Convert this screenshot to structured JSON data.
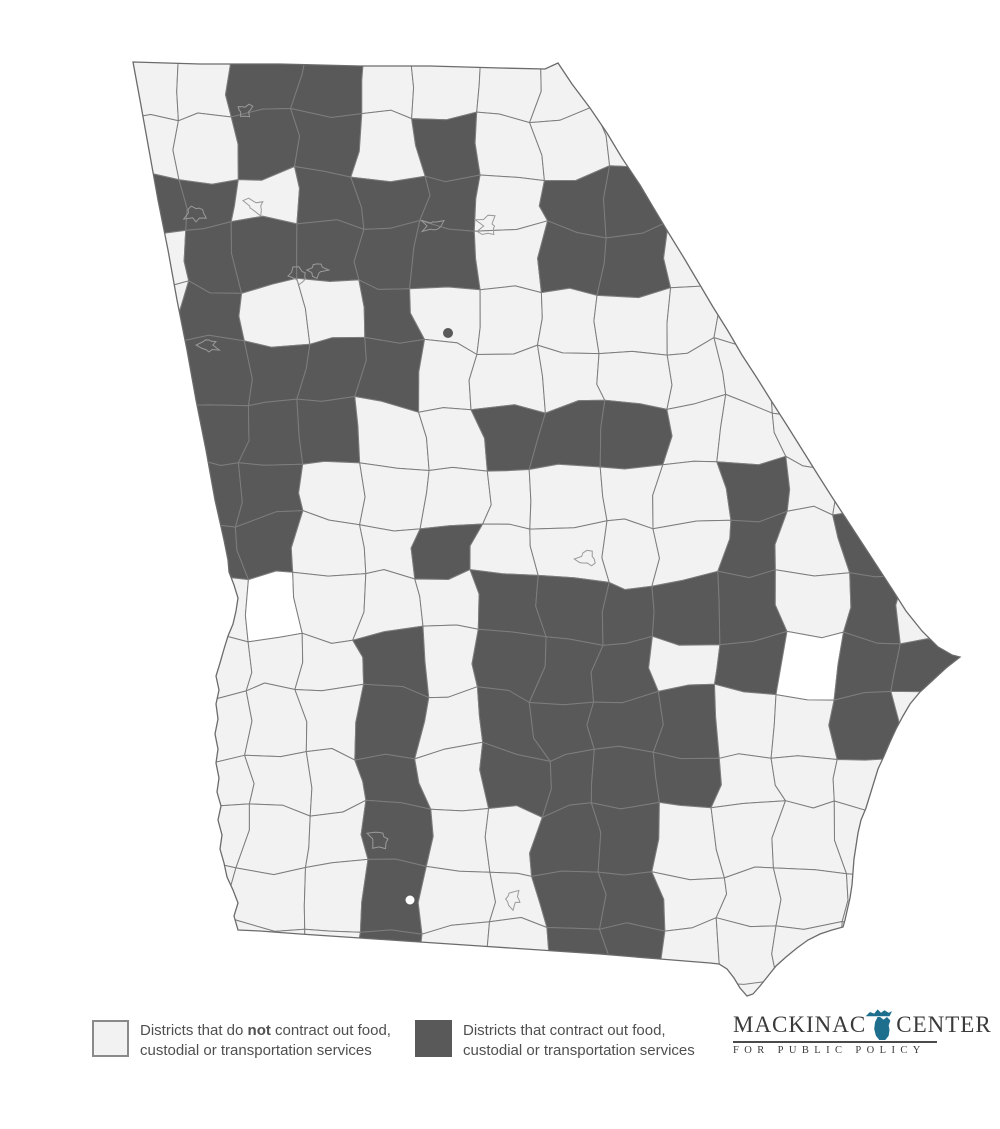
{
  "map": {
    "state": "Georgia",
    "description": "Georgia school districts (counties) shaded by whether they contract out food, custodial or transportation services",
    "colors": {
      "light_county": "#f2f2f2",
      "dark_county": "#595959",
      "white_county": "#ffffff",
      "county_border": "#7d7d7d",
      "state_outline": "#6b6b6b",
      "city_outline": "#9a9a9a"
    },
    "grid": {
      "cols": 14,
      "rows": 16,
      "x0": 120,
      "y0": 56,
      "cw": 60,
      "ch": 58
    },
    "dark_cells": [
      [
        2,
        0
      ],
      [
        3,
        0
      ],
      [
        2,
        1
      ],
      [
        3,
        1
      ],
      [
        5,
        1
      ],
      [
        0,
        2
      ],
      [
        1,
        2
      ],
      [
        3,
        2
      ],
      [
        4,
        2
      ],
      [
        5,
        2
      ],
      [
        7,
        2
      ],
      [
        8,
        2
      ],
      [
        1,
        3
      ],
      [
        2,
        3
      ],
      [
        3,
        3
      ],
      [
        4,
        3
      ],
      [
        5,
        3
      ],
      [
        7,
        3
      ],
      [
        8,
        3
      ],
      [
        1,
        4
      ],
      [
        4,
        4
      ],
      [
        1,
        5
      ],
      [
        2,
        5
      ],
      [
        3,
        5
      ],
      [
        4,
        5
      ],
      [
        1,
        6
      ],
      [
        2,
        6
      ],
      [
        3,
        6
      ],
      [
        6,
        6
      ],
      [
        7,
        6
      ],
      [
        8,
        6
      ],
      [
        1,
        7
      ],
      [
        2,
        7
      ],
      [
        10,
        7
      ],
      [
        1,
        8
      ],
      [
        2,
        8
      ],
      [
        5,
        8
      ],
      [
        10,
        8
      ],
      [
        12,
        8
      ],
      [
        6,
        9
      ],
      [
        7,
        9
      ],
      [
        8,
        9
      ],
      [
        9,
        9
      ],
      [
        10,
        9
      ],
      [
        12,
        9
      ],
      [
        4,
        10
      ],
      [
        6,
        10
      ],
      [
        7,
        10
      ],
      [
        8,
        10
      ],
      [
        10,
        10
      ],
      [
        12,
        10
      ],
      [
        13,
        10
      ],
      [
        4,
        11
      ],
      [
        6,
        11
      ],
      [
        7,
        11
      ],
      [
        8,
        11
      ],
      [
        9,
        11
      ],
      [
        12,
        11
      ],
      [
        4,
        12
      ],
      [
        6,
        12
      ],
      [
        7,
        12
      ],
      [
        8,
        12
      ],
      [
        9,
        12
      ],
      [
        4,
        13
      ],
      [
        7,
        13
      ],
      [
        8,
        13
      ],
      [
        4,
        14
      ],
      [
        7,
        14
      ],
      [
        8,
        14
      ],
      [
        4,
        15
      ],
      [
        7,
        15
      ],
      [
        8,
        15
      ]
    ],
    "white_cells": [
      [
        2,
        9
      ],
      [
        11,
        10
      ]
    ],
    "outline": [
      [
        133,
        62
      ],
      [
        200,
        64
      ],
      [
        280,
        64
      ],
      [
        360,
        66
      ],
      [
        430,
        66
      ],
      [
        500,
        68
      ],
      [
        545,
        69
      ],
      [
        558,
        63
      ],
      [
        572,
        84
      ],
      [
        590,
        108
      ],
      [
        607,
        133
      ],
      [
        622,
        158
      ],
      [
        640,
        185
      ],
      [
        653,
        207
      ],
      [
        668,
        232
      ],
      [
        684,
        258
      ],
      [
        700,
        285
      ],
      [
        713,
        307
      ],
      [
        728,
        331
      ],
      [
        742,
        355
      ],
      [
        757,
        378
      ],
      [
        772,
        402
      ],
      [
        788,
        427
      ],
      [
        803,
        451
      ],
      [
        818,
        475
      ],
      [
        832,
        497
      ],
      [
        847,
        520
      ],
      [
        862,
        543
      ],
      [
        877,
        566
      ],
      [
        892,
        589
      ],
      [
        906,
        611
      ],
      [
        922,
        631
      ],
      [
        938,
        647
      ],
      [
        952,
        655
      ],
      [
        960,
        657
      ],
      [
        946,
        668
      ],
      [
        933,
        680
      ],
      [
        920,
        692
      ],
      [
        910,
        704
      ],
      [
        903,
        716
      ],
      [
        896,
        729
      ],
      [
        890,
        742
      ],
      [
        884,
        756
      ],
      [
        878,
        769
      ],
      [
        874,
        782
      ],
      [
        870,
        795
      ],
      [
        866,
        808
      ],
      [
        861,
        820
      ],
      [
        858,
        833
      ],
      [
        856,
        846
      ],
      [
        854,
        859
      ],
      [
        853,
        872
      ],
      [
        852,
        885
      ],
      [
        850,
        898
      ],
      [
        847,
        911
      ],
      [
        845,
        920
      ],
      [
        843,
        927
      ],
      [
        832,
        930
      ],
      [
        820,
        934
      ],
      [
        808,
        940
      ],
      [
        797,
        948
      ],
      [
        786,
        957
      ],
      [
        776,
        966
      ],
      [
        768,
        976
      ],
      [
        760,
        986
      ],
      [
        753,
        994
      ],
      [
        747,
        996
      ],
      [
        740,
        988
      ],
      [
        734,
        978
      ],
      [
        727,
        969
      ],
      [
        719,
        964
      ],
      [
        710,
        963
      ],
      [
        660,
        959
      ],
      [
        600,
        954
      ],
      [
        540,
        950
      ],
      [
        480,
        946
      ],
      [
        420,
        942
      ],
      [
        360,
        938
      ],
      [
        300,
        934
      ],
      [
        260,
        931
      ],
      [
        238,
        930
      ],
      [
        234,
        916
      ],
      [
        238,
        903
      ],
      [
        233,
        890
      ],
      [
        227,
        877
      ],
      [
        224,
        863
      ],
      [
        220,
        849
      ],
      [
        222,
        835
      ],
      [
        218,
        820
      ],
      [
        221,
        806
      ],
      [
        217,
        792
      ],
      [
        219,
        778
      ],
      [
        216,
        763
      ],
      [
        218,
        749
      ],
      [
        215,
        734
      ],
      [
        218,
        719
      ],
      [
        216,
        704
      ],
      [
        219,
        690
      ],
      [
        216,
        676
      ],
      [
        220,
        663
      ],
      [
        224,
        649
      ],
      [
        228,
        636
      ],
      [
        233,
        624
      ],
      [
        236,
        611
      ],
      [
        238,
        598
      ],
      [
        234,
        585
      ],
      [
        229,
        572
      ],
      [
        228,
        560
      ],
      [
        224,
        540
      ],
      [
        215,
        500
      ],
      [
        206,
        450
      ],
      [
        196,
        400
      ],
      [
        187,
        350
      ],
      [
        177,
        300
      ],
      [
        168,
        250
      ],
      [
        158,
        200
      ],
      [
        149,
        150
      ],
      [
        140,
        100
      ]
    ],
    "city_marks": [
      [
        245,
        110
      ],
      [
        196,
        213
      ],
      [
        254,
        206
      ],
      [
        317,
        270
      ],
      [
        209,
        345
      ],
      [
        299,
        276
      ],
      [
        433,
        226
      ],
      [
        488,
        226
      ],
      [
        587,
        559
      ],
      [
        513,
        899
      ],
      [
        379,
        839
      ]
    ],
    "dark_dot": [
      448,
      333
    ],
    "white_dot": [
      410,
      900
    ]
  },
  "legend": {
    "items": [
      {
        "key": "no-contract",
        "swatch": "light",
        "line1_pre": "Districts that do ",
        "line1_bold": "not",
        "line1_post": " contract out food,",
        "line2": "custodial or transportation services"
      },
      {
        "key": "contract",
        "swatch": "dark",
        "line1": "Districts that contract out food,",
        "line2": "custodial or transportation services"
      }
    ]
  },
  "logo": {
    "word1": "MACKINAC",
    "word2": "CENTER",
    "subtitle": "FOR PUBLIC POLICY",
    "michigan_icon_color": "#1e6f8e"
  }
}
